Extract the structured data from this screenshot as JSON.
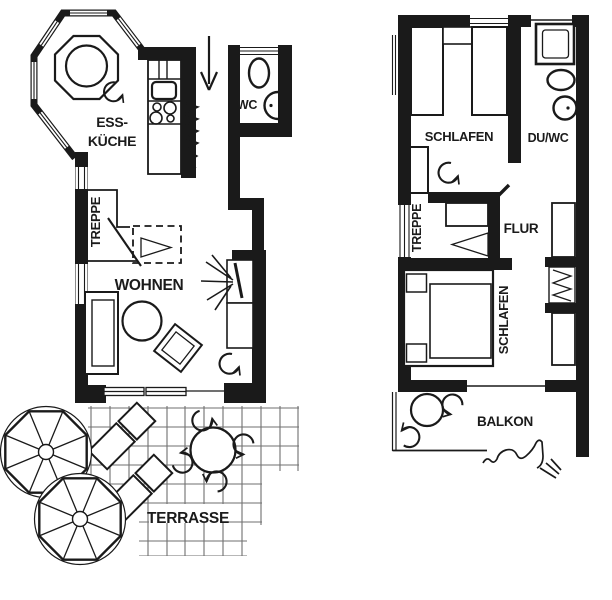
{
  "page": {
    "background": "#ffffff",
    "ink_color": "#1a1a1a",
    "grid_color": "#6f6f6f"
  },
  "ground_floor": {
    "labels": {
      "kitchen_line1": "ESS-",
      "kitchen_line2": "KÜCHE",
      "wc": "WC",
      "stairs": "TREPPE",
      "living": "WOHNEN",
      "terrace": "TERRASSE"
    }
  },
  "upper_floor": {
    "labels": {
      "bedroom_top": "SCHLAFEN",
      "shower_wc": "DU/WC",
      "stairs": "TREPPE",
      "hallway": "FLUR",
      "bedroom_main": "SCHLAFEN",
      "balcony": "BALKON"
    }
  }
}
